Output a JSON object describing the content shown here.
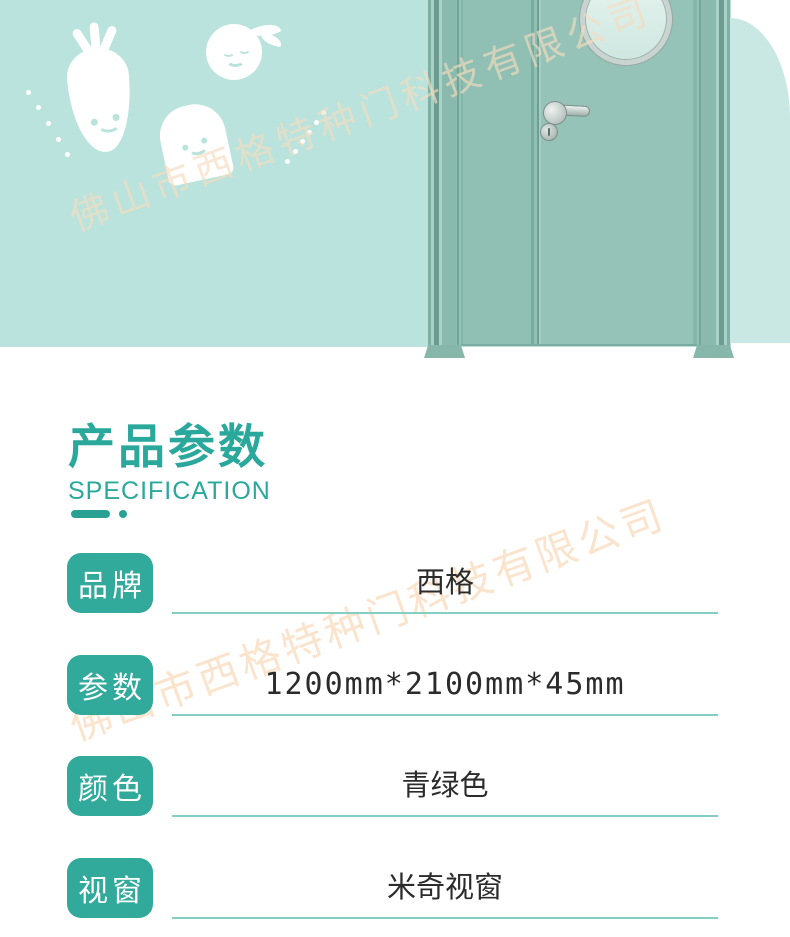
{
  "brand_watermark": "佛山市西格特种门科技有限公司",
  "header": {
    "title": "产品参数",
    "subtitle": "SPECIFICATION"
  },
  "spec_table": {
    "rows": [
      {
        "label": "品牌",
        "value": "西格"
      },
      {
        "label": "参数",
        "value": "1200mm*2100mm*45mm"
      },
      {
        "label": "颜色",
        "value": "青绿色"
      },
      {
        "label": "视窗",
        "value": "米奇视窗"
      }
    ]
  },
  "illustrations": {
    "door": "teal double door with round porthole window, lever handle and lock",
    "carrot": "smiling carrot character",
    "apple": "smiling apple character",
    "toast": "smiling toast character"
  },
  "colors": {
    "mint_background": "#bae3dd",
    "arch_panel": "#c9e8e3",
    "door_leaf": "#95c3b8",
    "teal_accent": "#2aa89b",
    "badge_teal": "#31a99b",
    "underline_teal": "#85cec4",
    "watermark_peach": "#f8dec6",
    "value_text": "#2b2b2b"
  }
}
